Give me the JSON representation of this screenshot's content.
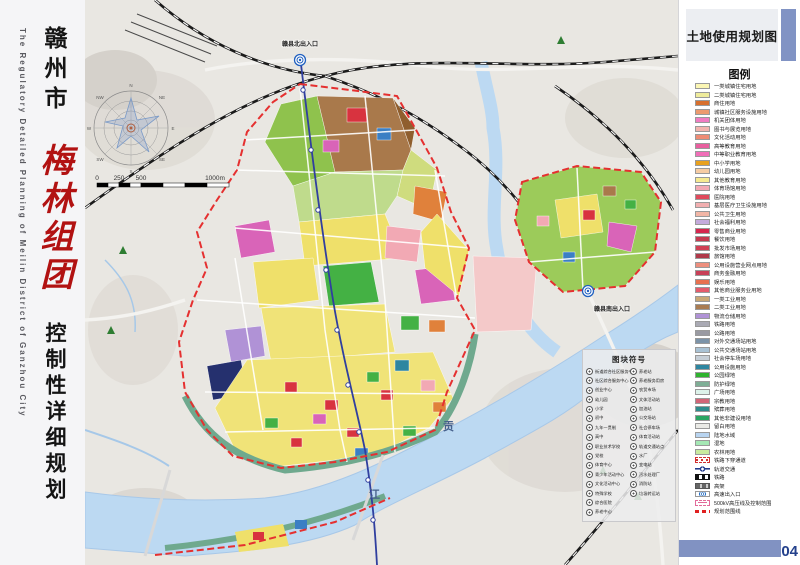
{
  "sidebar": {
    "city": "赣州市",
    "district": "梅林组团",
    "subtitle": "控制性详细规划",
    "english_title": "The  Regulatory  Detailed  Planning  of  Meilin  District  of  Ganzhou  City"
  },
  "legend": {
    "title": "土地使用规划图",
    "heading": "图例",
    "items": [
      {
        "label": "一类城镇住宅用地",
        "color": "#FBF6B4"
      },
      {
        "label": "二类城镇住宅用地",
        "color": "#EFEC9C"
      },
      {
        "label": "商住用地",
        "color": "#D8702E"
      },
      {
        "label": "城镇社区服务设施用地",
        "color": "#EC9A6E"
      },
      {
        "label": "机关团体用地",
        "color": "#F07CC2"
      },
      {
        "label": "图书与展览用地",
        "color": "#F2B4AE"
      },
      {
        "label": "文化活动用地",
        "color": "#EE8B74"
      },
      {
        "label": "高等教育用地",
        "color": "#E95F9F"
      },
      {
        "label": "中等职业教育用地",
        "color": "#F06FB8"
      },
      {
        "label": "中小学用地",
        "color": "#E9A11E"
      },
      {
        "label": "幼儿园用地",
        "color": "#F6CCA4"
      },
      {
        "label": "其他教育用地",
        "color": "#F6EA90"
      },
      {
        "label": "体育场馆用地",
        "color": "#F2A9B4"
      },
      {
        "label": "医院用地",
        "color": "#E04A5C"
      },
      {
        "label": "基层医疗卫生设施用地",
        "color": "#F2AFB0"
      },
      {
        "label": "公共卫生用地",
        "color": "#F2B6A6"
      },
      {
        "label": "社会福利用地",
        "color": "#C4AADC"
      },
      {
        "label": "零售商业用地",
        "color": "#D5264E"
      },
      {
        "label": "餐饮用地",
        "color": "#C53A50"
      },
      {
        "label": "批发市场用地",
        "color": "#D04055"
      },
      {
        "label": "旅馆用地",
        "color": "#B0394A"
      },
      {
        "label": "公用设施营业网点用地",
        "color": "#ED8F7E"
      },
      {
        "label": "商务金融用地",
        "color": "#C84058"
      },
      {
        "label": "娱乐用地",
        "color": "#E8714F"
      },
      {
        "label": "其他商业服务业用地",
        "color": "#E45C6C"
      },
      {
        "label": "一类工业用地",
        "color": "#C9A876"
      },
      {
        "label": "二类工业用地",
        "color": "#A97C52"
      },
      {
        "label": "物流仓储用地",
        "color": "#B092D6"
      },
      {
        "label": "铁路用地",
        "color": "#AAAAB4"
      },
      {
        "label": "公路用地",
        "color": "#9A9AA2"
      },
      {
        "label": "对外交通场站用地",
        "color": "#7C93A8"
      },
      {
        "label": "公共交通场站用地",
        "color": "#A9C2D4"
      },
      {
        "label": "社会停车场用地",
        "color": "#C6CED6"
      },
      {
        "label": "公用设施用地",
        "color": "#2E86A0"
      },
      {
        "label": "公园绿地",
        "color": "#2FB32F"
      },
      {
        "label": "防护绿地",
        "color": "#7FAE96"
      },
      {
        "label": "广场用地",
        "color": "#DDF2EA"
      },
      {
        "label": "宗教用地",
        "color": "#D26577"
      },
      {
        "label": "殡葬用地",
        "color": "#2E8C8C"
      },
      {
        "label": "其他非建设用地",
        "color": "#2AA662"
      },
      {
        "label": "留白用地",
        "color": "#EAEAE6"
      },
      {
        "label": "陆地水域",
        "color": "#B8D4F0"
      },
      {
        "label": "湿地",
        "color": "#A5E8B5"
      },
      {
        "label": "农林用地",
        "color": "#C9EA9F"
      }
    ],
    "symbols": [
      {
        "label": "铁路下穿通道",
        "kind": "underpass"
      },
      {
        "label": "轨道交通",
        "kind": "metro"
      },
      {
        "label": "铁路",
        "kind": "railway"
      },
      {
        "label": "高架",
        "kind": "elevated"
      },
      {
        "label": "高速出入口",
        "kind": "exit"
      },
      {
        "label": "500kV高压线及控制范围",
        "kind": "hv"
      },
      {
        "label": "规划范围线",
        "kind": "boundary"
      }
    ]
  },
  "map": {
    "exit_north": "赣县北出入口",
    "exit_south": "赣县南出入口",
    "river": {
      "c1": "贡",
      "c2": "江"
    },
    "scale": {
      "t0": "0",
      "t1": "250",
      "t2": "500",
      "t3": "1000m"
    },
    "compass": {
      "d0": "N",
      "d1": "NE",
      "d2": "E",
      "d3": "SE",
      "d4": "S",
      "d5": "SW",
      "d6": "W",
      "d7": "NW"
    },
    "panel": {
      "title": "图块符号",
      "left": [
        "街道综合社区服务中心",
        "社区综合服务中心",
        "创业中心",
        "幼儿园",
        "小学",
        "初中",
        "九年一贯制",
        "高中",
        "职业技术学校",
        "党校",
        "体育中心",
        "青少年活动中心",
        "文化活动中心",
        "特殊学校",
        "综合医院",
        "养老中心"
      ],
      "right": [
        "养老站",
        "养老服务用房",
        "农贸市场",
        "文体活动站",
        "加油站",
        "公交场站",
        "社会停车场",
        "体育活动站",
        "轨道交通站点",
        "水厂",
        "变电站",
        "污水处理厂",
        "消防站",
        "垃圾转运站"
      ]
    }
  },
  "footer": {
    "page": "04"
  }
}
